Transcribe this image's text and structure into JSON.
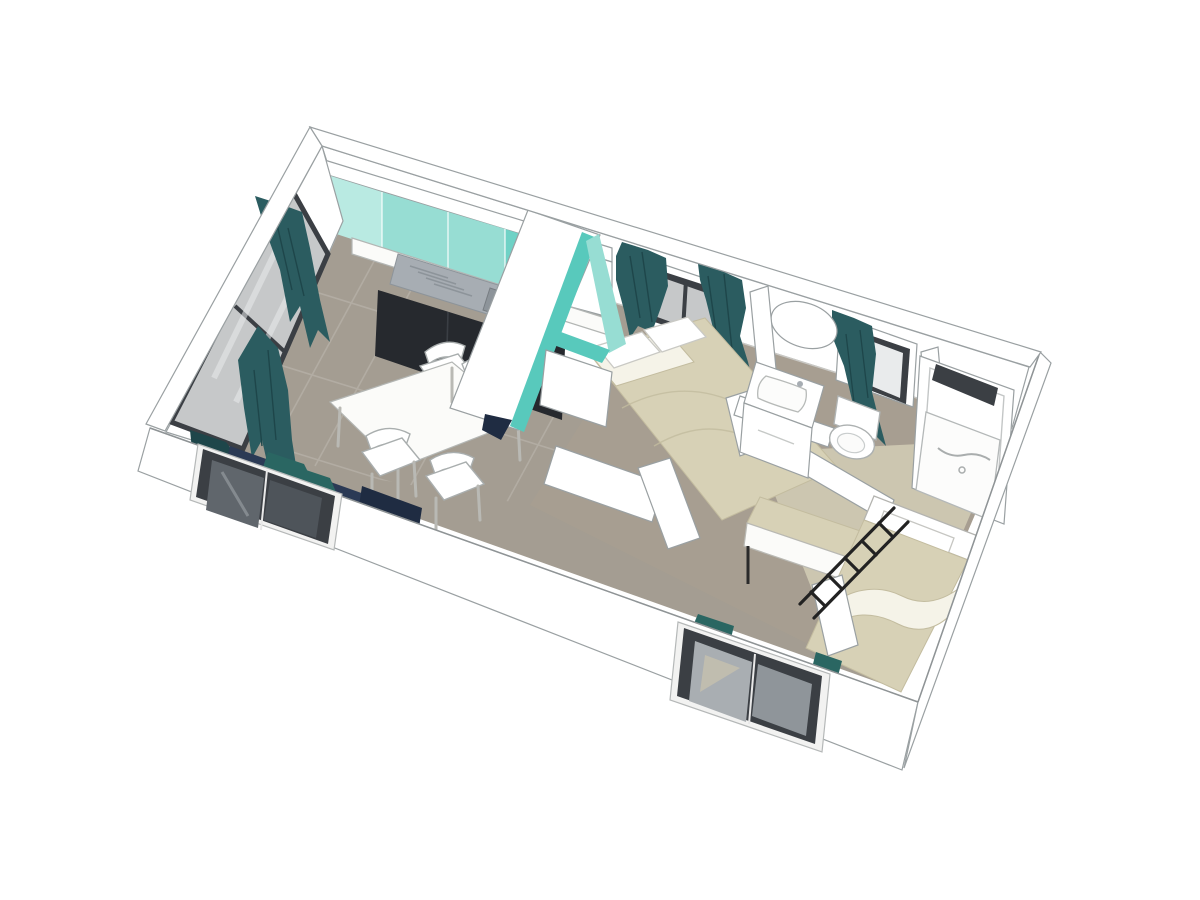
{
  "scene": {
    "type": "3d-floorplan-cutaway-render",
    "view": "isometric-top-down",
    "rooms": [
      {
        "name": "kitchen-living-room",
        "furniture": [
          "kitchen-upper-cabinets",
          "kitchen-sink-counter",
          "kitchen-base-cabinets",
          "dining-table",
          "dining-chairs-x4",
          "sofa-bench",
          "sliding-glass-door"
        ]
      },
      {
        "name": "master-bedroom",
        "furniture": [
          "double-bed",
          "pillows-x2",
          "teal-wardrobe-partition",
          "curtained-window"
        ]
      },
      {
        "name": "bathroom",
        "furniture": [
          "vanity-sink",
          "oval-mirror",
          "toilet",
          "curtained-window"
        ]
      },
      {
        "name": "shower-room",
        "furniture": [
          "shower-cabin",
          "shower-tray"
        ]
      },
      {
        "name": "second-bedroom",
        "furniture": [
          "single-bed",
          "bench-bed",
          "bunk-ladder",
          "teal-cushions",
          "window"
        ]
      }
    ],
    "exterior": [
      "dark-framed-window-left",
      "dark-framed-window-bottom"
    ]
  },
  "colors": {
    "background": "#ffffff",
    "wall": "#ffffff",
    "outline": "#9aa0a2",
    "floor": "#a49d92",
    "floor_grout": "#b6b0a6",
    "floor_warm": "#ab9f90",
    "room2_floor": "#ccc6b0",
    "teal_light": "#b9eae2",
    "teal": "#97ddd3",
    "teal_deep": "#6fd2c6",
    "teal_edge": "#58c9bc",
    "counter_dark": "#26292e",
    "counter_divider": "#3a3e44",
    "steel": "#a7adb3",
    "steel_dark": "#8d949a",
    "steel_deep": "#777d82",
    "curtain": "#2b5c60",
    "curtain_shadow": "#1e464a",
    "glass": "#c6c8c9",
    "glass_bright": "#e9ebec",
    "glass_pane_left": "#60666c",
    "glass_pane_right": "#4e545a",
    "glass_ext_left": "#a9aeb2",
    "glass_ext_right": "#8f959a",
    "glass_reflection": "#c6c0ae",
    "frame_dark": "#3b3f44",
    "sofa": "#2b3a55",
    "sofa_dark": "#1f2c42",
    "cushion": "#2a6662",
    "bed": "#d7d1b6",
    "bed_shadow": "#c3bc9f",
    "sheet": "#f5f3e8",
    "ladder": "#222222"
  }
}
